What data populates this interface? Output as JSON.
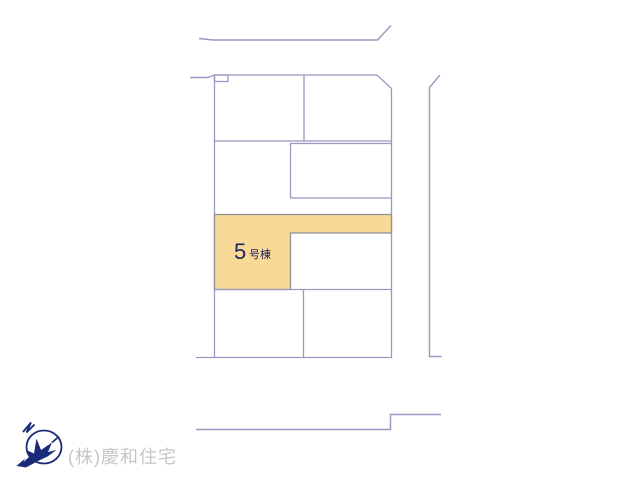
{
  "plan": {
    "type": "residential-site-plan",
    "highlight_lot": {
      "number": "5",
      "suffix": "号棟"
    }
  },
  "footer": {
    "company": "(株)慶和住宅"
  },
  "colors": {
    "accent_fill": "#f8d995",
    "line": "#9898c0",
    "lot_border": "#8f8f99",
    "label_text": "#23235f",
    "logo_navy": "#1b2a78",
    "watermark_text": "#c6c6c6"
  }
}
